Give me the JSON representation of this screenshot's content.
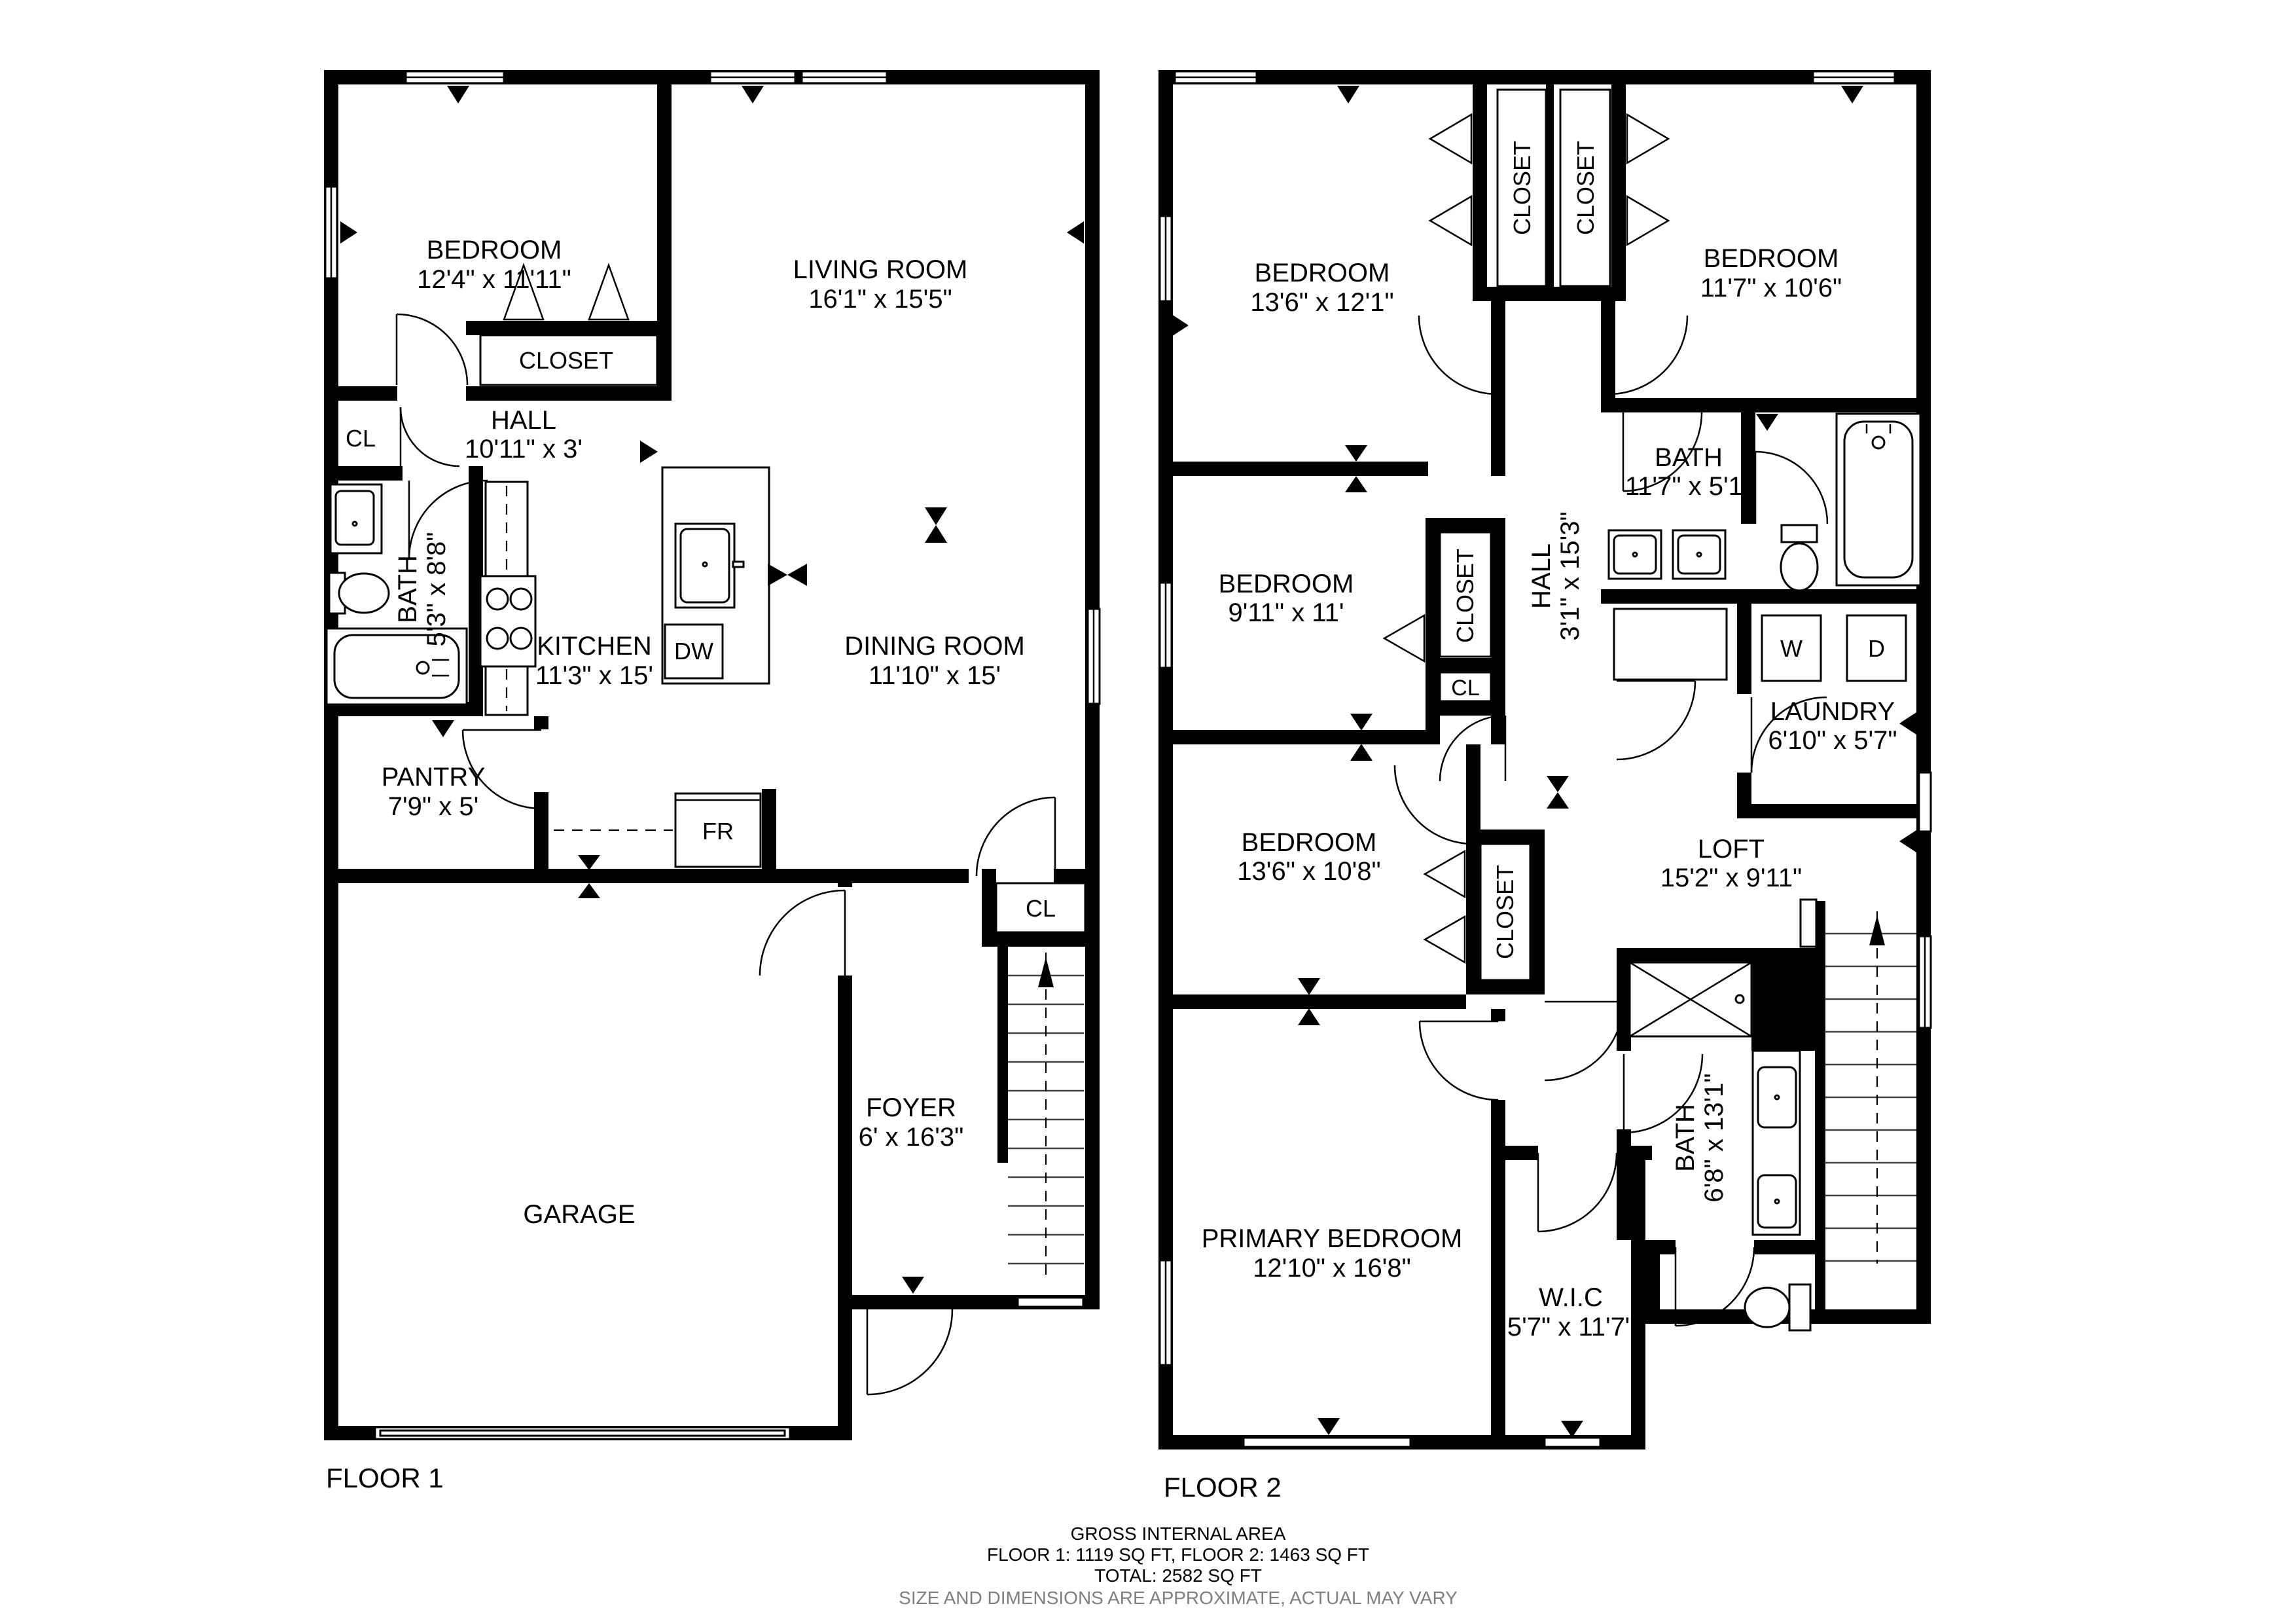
{
  "floor1": {
    "label": "FLOOR 1",
    "rooms": {
      "bedroom": {
        "name": "BEDROOM",
        "dims": "12'4\" x 11'11\""
      },
      "living": {
        "name": "LIVING ROOM",
        "dims": "16'1\" x 15'5\""
      },
      "closet": {
        "name": "CLOSET"
      },
      "cl_hall": {
        "name": "CL"
      },
      "hall": {
        "name": "HALL",
        "dims": "10'11\" x 3'"
      },
      "bath": {
        "name": "BATH",
        "dims": "5'3\" x 8'8\""
      },
      "kitchen": {
        "name": "KITCHEN",
        "dims": "11'3\" x 15'"
      },
      "dw": {
        "name": "DW"
      },
      "dining": {
        "name": "DINING ROOM",
        "dims": "11'10\" x 15'"
      },
      "pantry": {
        "name": "PANTRY",
        "dims": "7'9\" x 5'"
      },
      "fridge": {
        "name": "FR"
      },
      "cl_foyer": {
        "name": "CL"
      },
      "foyer": {
        "name": "FOYER",
        "dims": "6' x 16'3\""
      },
      "garage": {
        "name": "GARAGE"
      }
    }
  },
  "floor2": {
    "label": "FLOOR 2",
    "rooms": {
      "bedroom1": {
        "name": "BEDROOM",
        "dims": "13'6\" x 12'1\""
      },
      "closet1": {
        "name": "CLOSET"
      },
      "closet2": {
        "name": "CLOSET"
      },
      "bedroom2": {
        "name": "BEDROOM",
        "dims": "11'7\" x 10'6\""
      },
      "bath1": {
        "name": "BATH",
        "dims": "11'7\" x 5'1\""
      },
      "hall": {
        "name": "HALL",
        "dims": "3'1\" x 15'3\""
      },
      "washer": {
        "name": "W"
      },
      "dryer": {
        "name": "D"
      },
      "laundry": {
        "name": "LAUNDRY",
        "dims": "6'10\" x 5'7\""
      },
      "bedroom3": {
        "name": "BEDROOM",
        "dims": "9'11\" x 11'"
      },
      "closet3": {
        "name": "CLOSET"
      },
      "cl": {
        "name": "CL"
      },
      "bedroom4": {
        "name": "BEDROOM",
        "dims": "13'6\" x 10'8\""
      },
      "closet4": {
        "name": "CLOSET"
      },
      "loft": {
        "name": "LOFT",
        "dims": "15'2\" x 9'11\""
      },
      "bath2": {
        "name": "BATH",
        "dims": "6'8\" x 13'1\""
      },
      "primary": {
        "name": "PRIMARY BEDROOM",
        "dims": "12'10\" x 16'8\""
      },
      "wic": {
        "name": "W.I.C",
        "dims": "5'7\" x 11'7\""
      }
    }
  },
  "footer": {
    "line1": "GROSS INTERNAL AREA",
    "line2": "FLOOR 1: 1119 SQ FT, FLOOR 2: 1463 SQ FT",
    "line3": "TOTAL: 2582 SQ FT",
    "line4": "SIZE AND DIMENSIONS ARE APPROXIMATE, ACTUAL MAY VARY"
  }
}
